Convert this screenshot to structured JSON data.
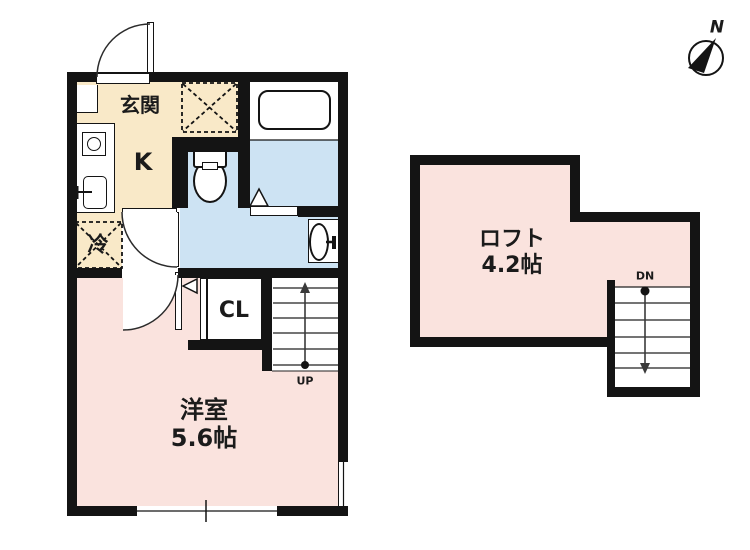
{
  "title": "間取り図 (apartment floor plan)",
  "colors": {
    "wall": "#141414",
    "kitchen_floor": "#F9E9C8",
    "wet_area_floor": "#CDE3F3",
    "room_floor": "#FAE3DE",
    "fixture_fill": "#FFFFFF",
    "line": "#2b2b2b"
  },
  "floor1": {
    "rooms": {
      "genkan": "玄関",
      "kitchen": "K",
      "fridge": "冷",
      "closet": "CL",
      "western_room": "洋室",
      "western_room_size": "5.6帖",
      "stairs": "UP"
    }
  },
  "floor2": {
    "rooms": {
      "loft": "ロフト",
      "loft_size": "4.2帖",
      "stairs": "DN"
    }
  },
  "compass": {
    "north": "N"
  }
}
